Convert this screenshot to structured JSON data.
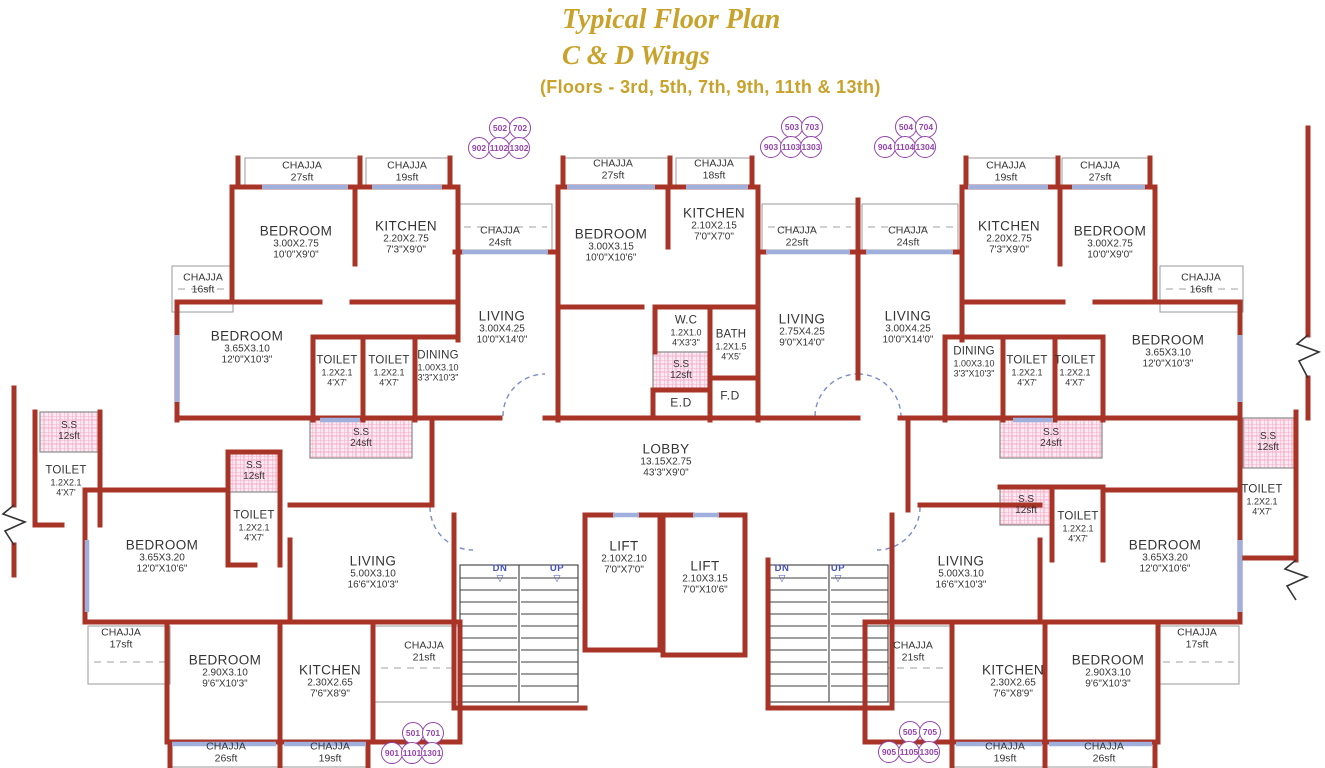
{
  "title": {
    "line1": "Typical Floor Plan",
    "line2": "C & D Wings",
    "line3": "(Floors - 3rd, 5th, 7th, 9th, 11th & 13th)"
  },
  "colors": {
    "title_gold": "#c9a22b",
    "wall_red": "#a83428",
    "window_blue": "#9fb0dc",
    "unit_purple": "#9344ad",
    "ss_pink": "#f2aec8",
    "stair_text_blue": "#4553b8"
  },
  "units": [
    {
      "cx": 499,
      "cy": 138,
      "top": [
        "502",
        "702"
      ],
      "bottom": [
        "902",
        "1102",
        "1302"
      ]
    },
    {
      "cx": 791,
      "cy": 137,
      "top": [
        "503",
        "703"
      ],
      "bottom": [
        "903",
        "1103",
        "1303"
      ]
    },
    {
      "cx": 905,
      "cy": 137,
      "top": [
        "504",
        "704"
      ],
      "bottom": [
        "904",
        "1104",
        "1304"
      ]
    },
    {
      "cx": 412,
      "cy": 743,
      "top": [
        "501",
        "701"
      ],
      "bottom": [
        "901",
        "1101",
        "1301"
      ]
    },
    {
      "cx": 909,
      "cy": 742,
      "top": [
        "505",
        "705"
      ],
      "bottom": [
        "905",
        "1105",
        "1305"
      ]
    }
  ],
  "labels": [
    {
      "k": "room",
      "t": "BEDROOM",
      "d1": "3.00X2.75",
      "d2": "10'0\"X9'0\"",
      "x": 296,
      "y": 242
    },
    {
      "k": "room",
      "t": "KITCHEN",
      "d1": "2.20X2.75",
      "d2": "7'3\"X9'0\"",
      "x": 406,
      "y": 237
    },
    {
      "k": "room",
      "t": "BEDROOM",
      "d1": "3.65X3.10",
      "d2": "12'0\"X10'3\"",
      "x": 247,
      "y": 347
    },
    {
      "k": "room",
      "t": "LIVING",
      "d1": "3.00X4.25",
      "d2": "10'0\"X14'0\"",
      "x": 502,
      "y": 327
    },
    {
      "k": "room",
      "t": "BEDROOM",
      "d1": "3.00X3.15",
      "d2": "10'0\"X10'6\"",
      "x": 611,
      "y": 245
    },
    {
      "k": "room",
      "t": "KITCHEN",
      "d1": "2.10X2.15",
      "d2": "7'0\"X7'0\"",
      "x": 714,
      "y": 224
    },
    {
      "k": "room",
      "t": "LIVING",
      "d1": "2.75X4.25",
      "d2": "9'0\"X14'0\"",
      "x": 802,
      "y": 330
    },
    {
      "k": "room",
      "t": "LIVING",
      "d1": "3.00X4.25",
      "d2": "10'0\"X14'0\"",
      "x": 908,
      "y": 327
    },
    {
      "k": "room",
      "t": "KITCHEN",
      "d1": "2.20X2.75",
      "d2": "7'3\"X9'0\"",
      "x": 1009,
      "y": 237
    },
    {
      "k": "room",
      "t": "BEDROOM",
      "d1": "3.00X2.75",
      "d2": "10'0\"X9'0\"",
      "x": 1110,
      "y": 242
    },
    {
      "k": "room",
      "t": "BEDROOM",
      "d1": "3.65X3.10",
      "d2": "12'0\"X10'3\"",
      "x": 1168,
      "y": 351
    },
    {
      "k": "room",
      "t": "LOBBY",
      "d1": "13.15X2.75",
      "d2": "43'3\"X9'0\"",
      "x": 666,
      "y": 460
    },
    {
      "k": "room",
      "t": "BEDROOM",
      "d1": "3.65X3.20",
      "d2": "12'0\"X10'6\"",
      "x": 162,
      "y": 556
    },
    {
      "k": "room",
      "t": "LIVING",
      "d1": "5.00X3.10",
      "d2": "16'6\"X10'3\"",
      "x": 373,
      "y": 572
    },
    {
      "k": "room",
      "t": "LIFT",
      "d1": "2.10X2.10",
      "d2": "7'0\"X7'0\"",
      "x": 624,
      "y": 557
    },
    {
      "k": "room",
      "t": "LIFT",
      "d1": "2.10X3.15",
      "d2": "7'0\"X10'6\"",
      "x": 705,
      "y": 577
    },
    {
      "k": "room",
      "t": "LIVING",
      "d1": "5.00X3.10",
      "d2": "16'6\"X10'3\"",
      "x": 961,
      "y": 572
    },
    {
      "k": "room",
      "t": "BEDROOM",
      "d1": "3.65X3.20",
      "d2": "12'0\"X10'6\"",
      "x": 1165,
      "y": 556
    },
    {
      "k": "room",
      "t": "BEDROOM",
      "d1": "2.90X3.10",
      "d2": "9'6\"X10'3\"",
      "x": 225,
      "y": 671
    },
    {
      "k": "room",
      "t": "KITCHEN",
      "d1": "2.30X2.65",
      "d2": "7'6\"X8'9\"",
      "x": 330,
      "y": 681
    },
    {
      "k": "room",
      "t": "KITCHEN",
      "d1": "2.30X2.65",
      "d2": "7'6\"X8'9\"",
      "x": 1013,
      "y": 681
    },
    {
      "k": "room",
      "t": "BEDROOM",
      "d1": "2.90X3.10",
      "d2": "9'6\"X10'3\"",
      "x": 1108,
      "y": 671
    },
    {
      "k": "small",
      "t": "TOILET",
      "d1": "1.2X2.1",
      "d2": "4'X7'",
      "x": 337,
      "y": 371
    },
    {
      "k": "small",
      "t": "TOILET",
      "d1": "1.2X2.1",
      "d2": "4'X7'",
      "x": 389,
      "y": 371
    },
    {
      "k": "small",
      "t": "DINING",
      "d1": "1.00X3.10",
      "d2": "3'3\"X10'3\"",
      "x": 438,
      "y": 366
    },
    {
      "k": "small",
      "t": "W.C",
      "d1": "1.2X1.0",
      "d2": "4'X3'3\"",
      "x": 686,
      "y": 331
    },
    {
      "k": "small",
      "t": "BATH",
      "d1": "1.2X1.5",
      "d2": "4'X5'",
      "x": 731,
      "y": 345
    },
    {
      "k": "small",
      "t": "DINING",
      "d1": "1.00X3.10",
      "d2": "3'3\"X10'3\"",
      "x": 974,
      "y": 362
    },
    {
      "k": "small",
      "t": "TOILET",
      "d1": "1.2X2.1",
      "d2": "4'X7'",
      "x": 1027,
      "y": 371
    },
    {
      "k": "small",
      "t": "TOILET",
      "d1": "1.2X2.1",
      "d2": "4'X7'",
      "x": 1075,
      "y": 371
    },
    {
      "k": "small",
      "t": "TOILET",
      "d1": "1.2X2.1",
      "d2": "4'X7'",
      "x": 66,
      "y": 481
    },
    {
      "k": "small",
      "t": "TOILET",
      "d1": "1.2X2.1",
      "d2": "4'X7'",
      "x": 254,
      "y": 526
    },
    {
      "k": "small",
      "t": "TOILET",
      "d1": "1.2X2.1",
      "d2": "4'X7'",
      "x": 1078,
      "y": 527
    },
    {
      "k": "small",
      "t": "TOILET",
      "d1": "1.2X2.1",
      "d2": "4'X7'",
      "x": 1262,
      "y": 500
    },
    {
      "k": "tag",
      "t": "E.D",
      "x": 681,
      "y": 403
    },
    {
      "k": "tag",
      "t": "F.D",
      "x": 730,
      "y": 396
    },
    {
      "k": "chajja",
      "t": "CHAJJA",
      "d1": "27sft",
      "x": 302,
      "y": 172
    },
    {
      "k": "chajja",
      "t": "CHAJJA",
      "d1": "19sft",
      "x": 407,
      "y": 172
    },
    {
      "k": "chajja",
      "t": "CHAJJA",
      "d1": "16sft",
      "x": 203,
      "y": 284
    },
    {
      "k": "chajja",
      "t": "CHAJJA",
      "d1": "24sft",
      "x": 500,
      "y": 237
    },
    {
      "k": "chajja",
      "t": "CHAJJA",
      "d1": "27sft",
      "x": 613,
      "y": 170
    },
    {
      "k": "chajja",
      "t": "CHAJJA",
      "d1": "18sft",
      "x": 714,
      "y": 170
    },
    {
      "k": "chajja",
      "t": "CHAJJA",
      "d1": "22sft",
      "x": 797,
      "y": 237
    },
    {
      "k": "chajja",
      "t": "CHAJJA",
      "d1": "24sft",
      "x": 908,
      "y": 237
    },
    {
      "k": "chajja",
      "t": "CHAJJA",
      "d1": "19sft",
      "x": 1006,
      "y": 172
    },
    {
      "k": "chajja",
      "t": "CHAJJA",
      "d1": "27sft",
      "x": 1100,
      "y": 172
    },
    {
      "k": "chajja",
      "t": "CHAJJA",
      "d1": "16sft",
      "x": 1201,
      "y": 284
    },
    {
      "k": "chajja",
      "t": "CHAJJA",
      "d1": "17sft",
      "x": 121,
      "y": 639
    },
    {
      "k": "chajja",
      "t": "CHAJJA",
      "d1": "21sft",
      "x": 424,
      "y": 652
    },
    {
      "k": "chajja",
      "t": "CHAJJA",
      "d1": "26sft",
      "x": 226,
      "y": 753
    },
    {
      "k": "chajja",
      "t": "CHAJJA",
      "d1": "19sft",
      "x": 330,
      "y": 753
    },
    {
      "k": "chajja",
      "t": "CHAJJA",
      "d1": "21sft",
      "x": 913,
      "y": 652
    },
    {
      "k": "chajja",
      "t": "CHAJJA",
      "d1": "17sft",
      "x": 1197,
      "y": 639
    },
    {
      "k": "chajja",
      "t": "CHAJJA",
      "d1": "19sft",
      "x": 1005,
      "y": 753
    },
    {
      "k": "chajja",
      "t": "CHAJJA",
      "d1": "26sft",
      "x": 1104,
      "y": 753
    },
    {
      "k": "ss",
      "t": "S.S",
      "d1": "24sft",
      "x": 361,
      "y": 438
    },
    {
      "k": "ss",
      "t": "S.S",
      "d1": "12sft",
      "x": 681,
      "y": 370
    },
    {
      "k": "ss",
      "t": "S.S",
      "d1": "24sft",
      "x": 1051,
      "y": 438
    },
    {
      "k": "ss",
      "t": "S.S",
      "d1": "12sft",
      "x": 1268,
      "y": 442
    },
    {
      "k": "ss",
      "t": "S.S",
      "d1": "12sft",
      "x": 69,
      "y": 431
    },
    {
      "k": "ss",
      "t": "S.S",
      "d1": "12sft",
      "x": 254,
      "y": 471
    },
    {
      "k": "ss",
      "t": "S.S",
      "d1": "12sft",
      "x": 1026,
      "y": 505
    },
    {
      "k": "stair",
      "t": "DN",
      "x": 500,
      "y": 573
    },
    {
      "k": "stair",
      "t": "UP",
      "x": 557,
      "y": 573
    },
    {
      "k": "stair",
      "t": "DN",
      "x": 782,
      "y": 573
    },
    {
      "k": "stair",
      "t": "UP",
      "x": 838,
      "y": 573
    }
  ]
}
